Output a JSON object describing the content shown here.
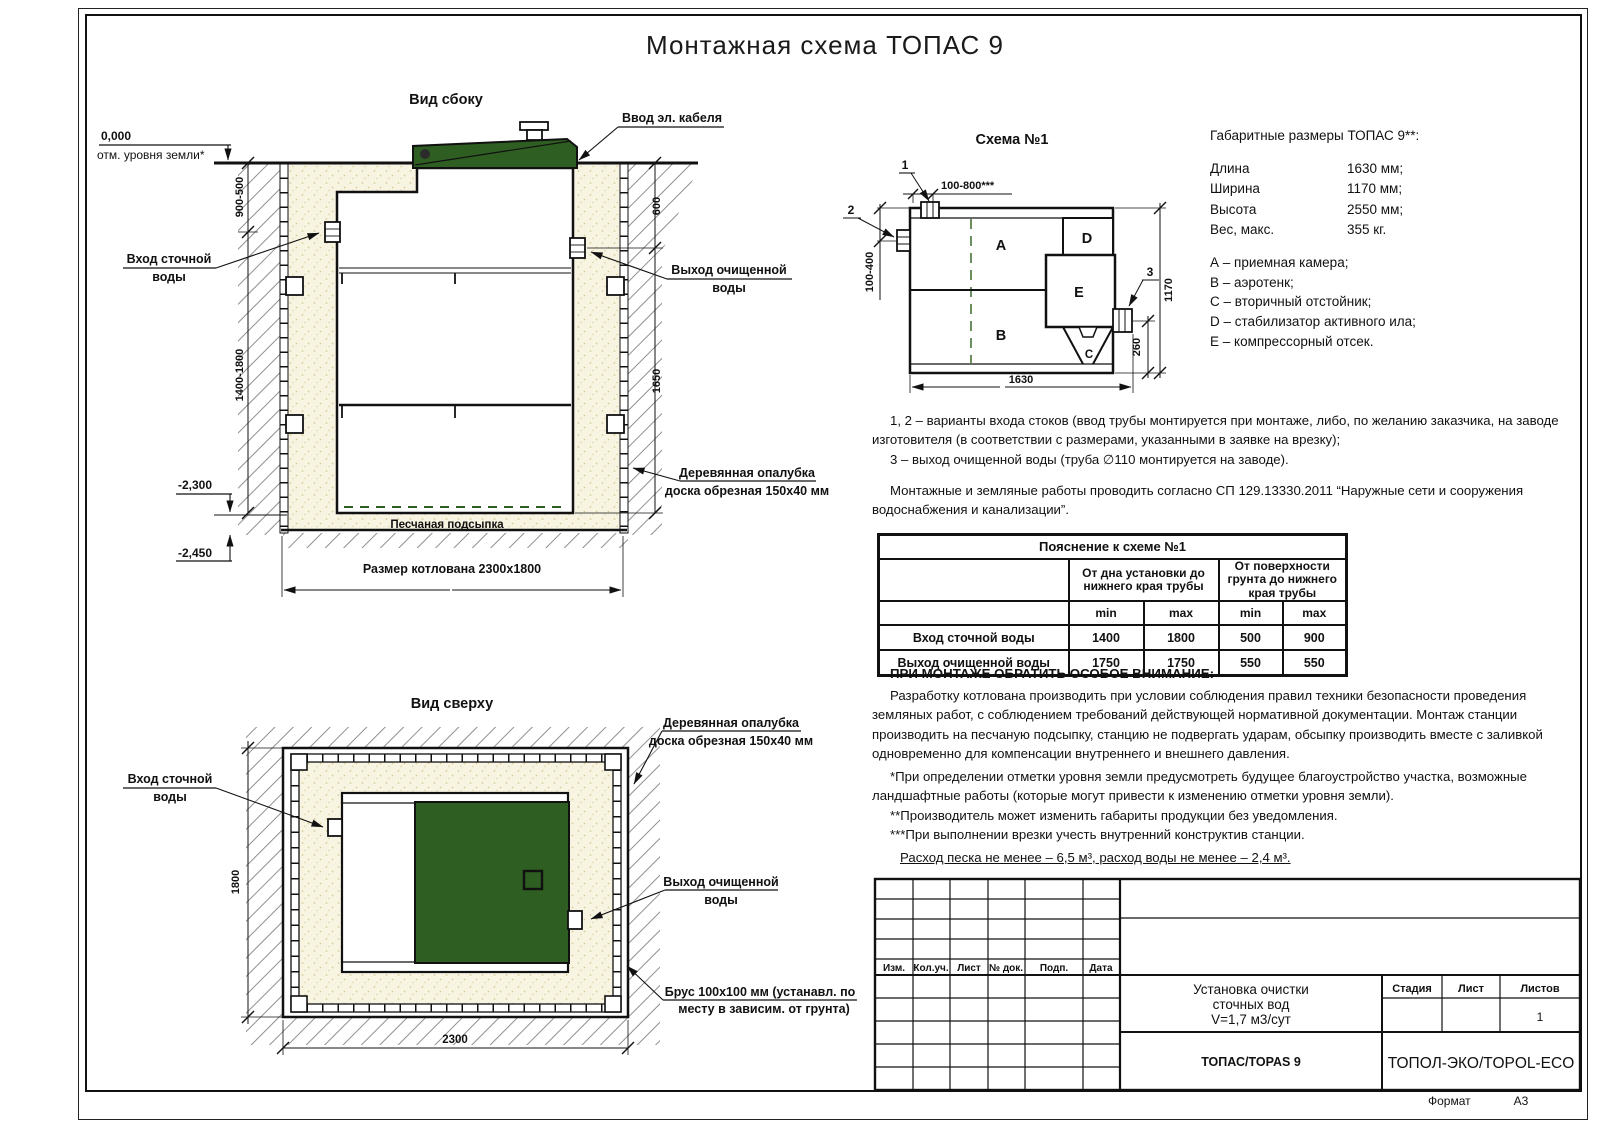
{
  "page_title": "Монтажная схема ТОПАС 9",
  "labels": {
    "inlet_1": "Вход сточной",
    "inlet_2": "воды",
    "outlet_1": "Выход очищенной",
    "outlet_2": "воды",
    "formwork_1": "Деревянная опалубка",
    "formwork_2": "доска обрезная 150х40 мм"
  },
  "side_view": {
    "title": "Вид сбоку",
    "zero_mark": "0,000",
    "zero_note": "отм. уровня земли*",
    "cable": "Ввод эл. кабеля",
    "dim_depth_top": "900-500",
    "dim_depth_bottom": "1400-1800",
    "dim_out_top": "600",
    "dim_out_bottom": "1650",
    "mark_bottom": "-2,300",
    "mark_sand": "-2,450",
    "sand_label": "Песчаная подсыпка",
    "pit_size": "Размер котлована 2300х1800"
  },
  "top_view": {
    "title": "Вид сверху",
    "dim_width": "1800",
    "dim_length": "2300",
    "brus_1": "Брус 100х100 мм (устанавл. по",
    "brus_2": "месту в зависим. от грунта)"
  },
  "schema": {
    "title": "Схема №1",
    "callout_1": "1",
    "callout_2": "2",
    "callout_3": "3",
    "dim_top": "100-800***",
    "dim_left": "100-400",
    "dim_height": "1170",
    "dim_outlet": "260",
    "dim_length": "1630",
    "chamber_a": "A",
    "chamber_b": "B",
    "chamber_c": "C",
    "chamber_d": "D",
    "chamber_e": "E"
  },
  "overall": {
    "title": "Габаритные размеры ТОПАС 9**:",
    "rows": [
      {
        "name": "Длина",
        "value": "1630 мм;"
      },
      {
        "name": "Ширина",
        "value": "1170 мм;"
      },
      {
        "name": "Высота",
        "value": "2550 мм;"
      },
      {
        "name": "Вес, макс.",
        "value": "355 кг."
      }
    ],
    "legend": [
      "А – приемная камера;",
      "В – аэротенк;",
      "С – вторичный отстойник;",
      "D – стабилизатор активного ила;",
      "Е – компрессорный отсек."
    ]
  },
  "notes": {
    "p1": "1, 2 – варианты входа  стоков (ввод трубы монтируется при монтаже, либо, по желанию заказчика, на заводе изготовителя (в соответствии с размерами, указанными в заявке на врезку);",
    "p2": "3 – выход очищенной воды (труба ∅110 монтируется на заводе).",
    "p3": "Монтажные и земляные работы проводить согласно СП 129.13330.2011 “Наружные сети и сооружения водоснабжения и канализации”."
  },
  "table": {
    "title": "Пояснение к схеме №1",
    "group_1": "От дна установки до нижнего края трубы",
    "group_2": "От поверхности грунта до нижнего края трубы",
    "min": "min",
    "max": "max",
    "rows": [
      {
        "name": "Вход сточной воды",
        "values": [
          "1400",
          "1800",
          "500",
          "900"
        ]
      },
      {
        "name": "Выход очищенной воды",
        "values": [
          "1750",
          "1750",
          "550",
          "550"
        ]
      }
    ]
  },
  "attention": {
    "title": "ПРИ МОНТАЖЕ ОБРАТИТЬ ОСОБОЕ ВНИМАНИЕ:",
    "p1": "Разработку котлована производить при условии соблюдения правил техники безопасности проведения земляных работ, с соблюдением требований действующей нормативной документации. Монтаж станции производить на песчаную подсыпку, станцию не подвергать ударам, обсыпку производить вместе с заливкой одновременно для компенсации внутреннего и внешнего давления.",
    "note1": "*При определении отметки уровня земли предусмотреть будущее благоустройство участка, возможные ландшафтные работы (которые могут привести к изменению отметки уровня земли).",
    "note2": "**Производитель может изменить габариты продукции без уведомления.",
    "note3": "***При выполнении врезки учесть внутренний конструктив станции.",
    "consumption": "Расход песка не менее – 6,5 м³, расход воды не менее – 2,4 м³."
  },
  "title_block": {
    "header_cols": [
      "Изм.",
      "Кол.уч.",
      "Лист",
      "№ док.",
      "Подп.",
      "Дата"
    ],
    "doc_title_1": "Установка очистки",
    "doc_title_2": "сточных вод",
    "doc_title_3": "V=1,7 м3/сут",
    "stage_label": "Стадия",
    "sheet_label": "Лист",
    "sheets_label": "Листов",
    "sheets_value": "1",
    "model": "ТОПАС/TOPAS 9",
    "company": "ТОПОЛ-ЭКО/TOPOL-ECO",
    "format_label": "Формат",
    "format_value": "А3"
  },
  "colors": {
    "lid_green": "#2f5e22",
    "sand": "#f8f4e2",
    "hatch_gray": "#8f8f8f",
    "line": "#111111"
  }
}
